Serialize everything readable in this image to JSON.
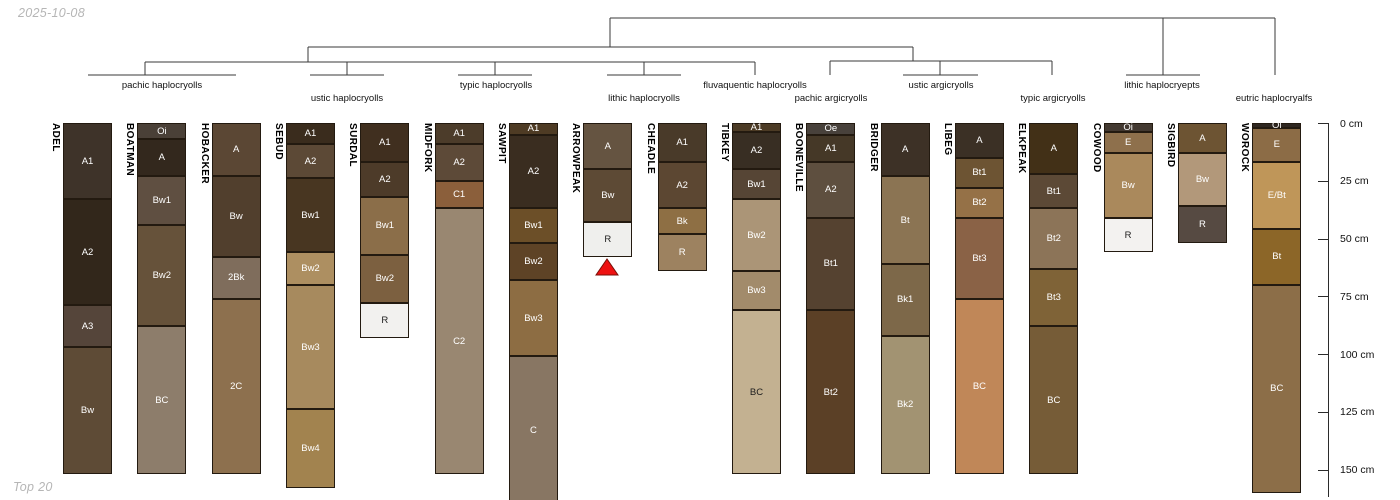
{
  "header": {
    "date_label": "2025-10-08",
    "footer_label": "Top 20"
  },
  "layout": {
    "top_y": 123,
    "px_per_cm": 2.31,
    "col_width": 49,
    "col_left_start": 63,
    "col_spacing": 74.33
  },
  "depth_axis": {
    "axis_x": 1328,
    "tick_len": 10,
    "label_x": 1340,
    "line_bottom_y": 497,
    "ticks_cm": [
      0,
      25,
      50,
      75,
      100,
      125,
      150
    ],
    "tick_labels": [
      "0 cm",
      "25 cm",
      "50 cm",
      "75 cm",
      "100 cm",
      "125 cm",
      "150 cm"
    ]
  },
  "dendrogram": {
    "color": "#3a3a3a",
    "h_lines": [
      {
        "y": 18,
        "x1": 610,
        "x2": 1275
      },
      {
        "y": 47,
        "x1": 308,
        "x2": 913
      },
      {
        "y": 62,
        "x1": 145,
        "x2": 755
      },
      {
        "y": 61,
        "x1": 830,
        "x2": 1052
      },
      {
        "y": 75,
        "x1": 88,
        "x2": 236
      },
      {
        "y": 75,
        "x1": 310,
        "x2": 384
      },
      {
        "y": 75,
        "x1": 458,
        "x2": 532
      },
      {
        "y": 75,
        "x1": 607,
        "x2": 681
      },
      {
        "y": 75,
        "x1": 903,
        "x2": 978
      },
      {
        "y": 75,
        "x1": 1126,
        "x2": 1200
      }
    ],
    "v_lines": [
      {
        "x": 610,
        "y1": 18,
        "y2": 47
      },
      {
        "x": 1163,
        "y1": 18,
        "y2": 75
      },
      {
        "x": 1275,
        "y1": 18,
        "y2": 75
      },
      {
        "x": 308,
        "y1": 47,
        "y2": 62
      },
      {
        "x": 913,
        "y1": 47,
        "y2": 61
      },
      {
        "x": 145,
        "y1": 62,
        "y2": 75
      },
      {
        "x": 347,
        "y1": 62,
        "y2": 75
      },
      {
        "x": 495,
        "y1": 62,
        "y2": 75
      },
      {
        "x": 644,
        "y1": 62,
        "y2": 75
      },
      {
        "x": 755,
        "y1": 62,
        "y2": 75
      },
      {
        "x": 830,
        "y1": 61,
        "y2": 75
      },
      {
        "x": 940,
        "y1": 61,
        "y2": 75
      },
      {
        "x": 1052,
        "y1": 61,
        "y2": 75
      }
    ]
  },
  "group_labels": [
    {
      "label": "pachic haplocryolls",
      "x": 162,
      "row": 1
    },
    {
      "label": "ustic haplocryolls",
      "x": 347,
      "row": 2
    },
    {
      "label": "typic haplocryolls",
      "x": 496,
      "row": 1
    },
    {
      "label": "lithic haplocryolls",
      "x": 644,
      "row": 2
    },
    {
      "label": "fluvaquentic haplocryolls",
      "x": 755,
      "row": 1
    },
    {
      "label": "pachic argicryolls",
      "x": 831,
      "row": 2
    },
    {
      "label": "ustic argicryolls",
      "x": 941,
      "row": 1
    },
    {
      "label": "typic argicryolls",
      "x": 1053,
      "row": 2
    },
    {
      "label": "lithic haplocryepts",
      "x": 1162,
      "row": 1
    },
    {
      "label": "eutric haplocryalfs",
      "x": 1274,
      "row": 2
    }
  ],
  "marker": {
    "shape": "triangle-up",
    "below_profile": "ARROWPEAK",
    "color": "#ee1111",
    "stroke": "#7a0f08",
    "cx": 607,
    "top_y": 259,
    "bottom_y": 275,
    "half_width": 11
  },
  "chart_data": {
    "type": "other",
    "kind": "soil-profile-sketches-with-taxonomy-dendrogram",
    "depth_unit": "cm",
    "depth_range": [
      0,
      150
    ],
    "profiles": [
      {
        "name": "ADEL",
        "group": "pachic haplocryolls",
        "horizons": [
          {
            "name": "A1",
            "top": 0,
            "bottom": 33,
            "color": "#3e3329"
          },
          {
            "name": "A2",
            "top": 33,
            "bottom": 79,
            "color": "#32271b"
          },
          {
            "name": "A3",
            "top": 79,
            "bottom": 97,
            "color": "#55453a"
          },
          {
            "name": "Bw",
            "top": 97,
            "bottom": 152,
            "color": "#5e4b36"
          }
        ]
      },
      {
        "name": "BOATMAN",
        "group": "pachic haplocryolls",
        "horizons": [
          {
            "name": "Oi",
            "top": 0,
            "bottom": 7,
            "color": "#4a4037"
          },
          {
            "name": "A",
            "top": 7,
            "bottom": 23,
            "color": "#33281d"
          },
          {
            "name": "Bw1",
            "top": 23,
            "bottom": 44,
            "color": "#5f4f41"
          },
          {
            "name": "Bw2",
            "top": 44,
            "bottom": 88,
            "color": "#66523a"
          },
          {
            "name": "BC",
            "top": 88,
            "bottom": 152,
            "color": "#8d7d6b"
          }
        ]
      },
      {
        "name": "HOBACKER",
        "group": "pachic haplocryolls",
        "horizons": [
          {
            "name": "A",
            "top": 0,
            "bottom": 23,
            "color": "#5b4734"
          },
          {
            "name": "Bw",
            "top": 23,
            "bottom": 58,
            "color": "#513f2d"
          },
          {
            "name": "2Bk",
            "top": 58,
            "bottom": 76,
            "color": "#7f6d5c"
          },
          {
            "name": "2C",
            "top": 76,
            "bottom": 152,
            "color": "#8d704e"
          }
        ]
      },
      {
        "name": "SEBUD",
        "group": "ustic haplocryolls",
        "horizons": [
          {
            "name": "A1",
            "top": 0,
            "bottom": 9,
            "color": "#3a2c1d"
          },
          {
            "name": "A2",
            "top": 9,
            "bottom": 24,
            "color": "#5c4936"
          },
          {
            "name": "Bw1",
            "top": 24,
            "bottom": 56,
            "color": "#483621"
          },
          {
            "name": "Bw2",
            "top": 56,
            "bottom": 70,
            "color": "#ad8f61"
          },
          {
            "name": "Bw3",
            "top": 70,
            "bottom": 124,
            "color": "#a78a5e"
          },
          {
            "name": "Bw4",
            "top": 124,
            "bottom": 158,
            "color": "#a2834f"
          }
        ]
      },
      {
        "name": "SURDAL",
        "group": "ustic haplocryolls",
        "horizons": [
          {
            "name": "A1",
            "top": 0,
            "bottom": 17,
            "color": "#402f1f"
          },
          {
            "name": "A2",
            "top": 17,
            "bottom": 32,
            "color": "#4d3b29"
          },
          {
            "name": "Bw1",
            "top": 32,
            "bottom": 57,
            "color": "#8b6e49"
          },
          {
            "name": "Bw2",
            "top": 57,
            "bottom": 78,
            "color": "#7c6040"
          },
          {
            "name": "R",
            "top": 78,
            "bottom": 93,
            "color": "#f2f1ef"
          }
        ]
      },
      {
        "name": "MIDFORK",
        "group": "typic haplocryolls",
        "horizons": [
          {
            "name": "A1",
            "top": 0,
            "bottom": 9,
            "color": "#4c3c2a"
          },
          {
            "name": "A2",
            "top": 9,
            "bottom": 25,
            "color": "#5d4a38"
          },
          {
            "name": "C1",
            "top": 25,
            "bottom": 37,
            "color": "#8b5f3b"
          },
          {
            "name": "C2",
            "top": 37,
            "bottom": 152,
            "color": "#998771"
          }
        ]
      },
      {
        "name": "SAWPIT",
        "group": "typic haplocryolls",
        "horizons": [
          {
            "name": "A1",
            "top": 0,
            "bottom": 5,
            "color": "#4e3b24"
          },
          {
            "name": "A2",
            "top": 5,
            "bottom": 37,
            "color": "#3a2d20"
          },
          {
            "name": "Bw1",
            "top": 37,
            "bottom": 52,
            "color": "#6c4f28"
          },
          {
            "name": "Bw2",
            "top": 52,
            "bottom": 68,
            "color": "#5e4326"
          },
          {
            "name": "Bw3",
            "top": 68,
            "bottom": 101,
            "color": "#8d6d43"
          },
          {
            "name": "C",
            "top": 101,
            "bottom": 165,
            "color": "#887663"
          }
        ]
      },
      {
        "name": "ARROWPEAK",
        "group": "lithic haplocryolls",
        "horizons": [
          {
            "name": "A",
            "top": 0,
            "bottom": 20,
            "color": "#655441"
          },
          {
            "name": "Bw",
            "top": 20,
            "bottom": 43,
            "color": "#5d4a35"
          },
          {
            "name": "R",
            "top": 43,
            "bottom": 58,
            "color": "#efefed"
          }
        ]
      },
      {
        "name": "CHEADLE",
        "group": "lithic haplocryolls",
        "horizons": [
          {
            "name": "A1",
            "top": 0,
            "bottom": 17,
            "color": "#493a29"
          },
          {
            "name": "A2",
            "top": 17,
            "bottom": 37,
            "color": "#5c4732"
          },
          {
            "name": "Bk",
            "top": 37,
            "bottom": 48,
            "color": "#8e6f44"
          },
          {
            "name": "R",
            "top": 48,
            "bottom": 64,
            "color": "#9d8260"
          }
        ]
      },
      {
        "name": "TIBKEY",
        "group": "fluvaquentic haplocryolls",
        "horizons": [
          {
            "name": "A1",
            "top": 0,
            "bottom": 4,
            "color": "#4c3b25"
          },
          {
            "name": "A2",
            "top": 4,
            "bottom": 20,
            "color": "#382e23"
          },
          {
            "name": "Bw1",
            "top": 20,
            "bottom": 33,
            "color": "#564535"
          },
          {
            "name": "Bw2",
            "top": 33,
            "bottom": 64,
            "color": "#ab9577"
          },
          {
            "name": "Bw3",
            "top": 64,
            "bottom": 81,
            "color": "#a28b6b"
          },
          {
            "name": "BC",
            "top": 81,
            "bottom": 152,
            "color": "#c3b191"
          }
        ]
      },
      {
        "name": "BOONEVILLE",
        "group": "pachic argicryolls",
        "horizons": [
          {
            "name": "Oe",
            "top": 0,
            "bottom": 5,
            "color": "#48413b"
          },
          {
            "name": "A1",
            "top": 5,
            "bottom": 17,
            "color": "#453827"
          },
          {
            "name": "A2",
            "top": 17,
            "bottom": 41,
            "color": "#5e4f3f"
          },
          {
            "name": "Bt1",
            "top": 41,
            "bottom": 81,
            "color": "#554230"
          },
          {
            "name": "Bt2",
            "top": 81,
            "bottom": 152,
            "color": "#5b4026"
          }
        ]
      },
      {
        "name": "BRIDGER",
        "group": "ustic argicryolls",
        "horizons": [
          {
            "name": "A",
            "top": 0,
            "bottom": 23,
            "color": "#3d3126"
          },
          {
            "name": "Bt",
            "top": 23,
            "bottom": 61,
            "color": "#8b7453"
          },
          {
            "name": "Bk1",
            "top": 61,
            "bottom": 92,
            "color": "#7d6849"
          },
          {
            "name": "Bk2",
            "top": 92,
            "bottom": 152,
            "color": "#a29372"
          }
        ]
      },
      {
        "name": "LIBEG",
        "group": "ustic argicryolls",
        "horizons": [
          {
            "name": "A",
            "top": 0,
            "bottom": 15,
            "color": "#3b3025"
          },
          {
            "name": "Bt1",
            "top": 15,
            "bottom": 28,
            "color": "#6d5433"
          },
          {
            "name": "Bt2",
            "top": 28,
            "bottom": 41,
            "color": "#957147"
          },
          {
            "name": "Bt3",
            "top": 41,
            "bottom": 76,
            "color": "#8a6246"
          },
          {
            "name": "BC",
            "top": 76,
            "bottom": 152,
            "color": "#c08758"
          }
        ]
      },
      {
        "name": "ELKPEAK",
        "group": "typic argicryolls",
        "horizons": [
          {
            "name": "A",
            "top": 0,
            "bottom": 22,
            "color": "#423017"
          },
          {
            "name": "Bt1",
            "top": 22,
            "bottom": 37,
            "color": "#5c4936"
          },
          {
            "name": "Bt2",
            "top": 37,
            "bottom": 63,
            "color": "#8c7458"
          },
          {
            "name": "Bt3",
            "top": 63,
            "bottom": 88,
            "color": "#7f6337"
          },
          {
            "name": "BC",
            "top": 88,
            "bottom": 152,
            "color": "#765c37"
          }
        ]
      },
      {
        "name": "COWOOD",
        "group": "lithic haplocryepts",
        "horizons": [
          {
            "name": "Oi",
            "top": 0,
            "bottom": 4,
            "color": "#433931"
          },
          {
            "name": "E",
            "top": 4,
            "bottom": 13,
            "color": "#8e704c"
          },
          {
            "name": "Bw",
            "top": 13,
            "bottom": 41,
            "color": "#aa895c"
          },
          {
            "name": "R",
            "top": 41,
            "bottom": 56,
            "color": "#f3f2f0"
          }
        ]
      },
      {
        "name": "SIGBIRD",
        "group": "lithic haplocryepts",
        "horizons": [
          {
            "name": "A",
            "top": 0,
            "bottom": 13,
            "color": "#6d5433"
          },
          {
            "name": "Bw",
            "top": 13,
            "bottom": 36,
            "color": "#b2987a"
          },
          {
            "name": "R",
            "top": 36,
            "bottom": 52,
            "color": "#564a42"
          }
        ]
      },
      {
        "name": "WOROCK",
        "group": "eutric haplocryalfs",
        "horizons": [
          {
            "name": "Oi",
            "top": 0,
            "bottom": 2,
            "color": "#2f2721"
          },
          {
            "name": "E",
            "top": 2,
            "bottom": 17,
            "color": "#8c6c46"
          },
          {
            "name": "E/Bt",
            "top": 17,
            "bottom": 46,
            "color": "#bf9659"
          },
          {
            "name": "Bt",
            "top": 46,
            "bottom": 70,
            "color": "#8c6628"
          },
          {
            "name": "BC",
            "top": 70,
            "bottom": 160,
            "color": "#8c6e48"
          }
        ]
      }
    ]
  }
}
